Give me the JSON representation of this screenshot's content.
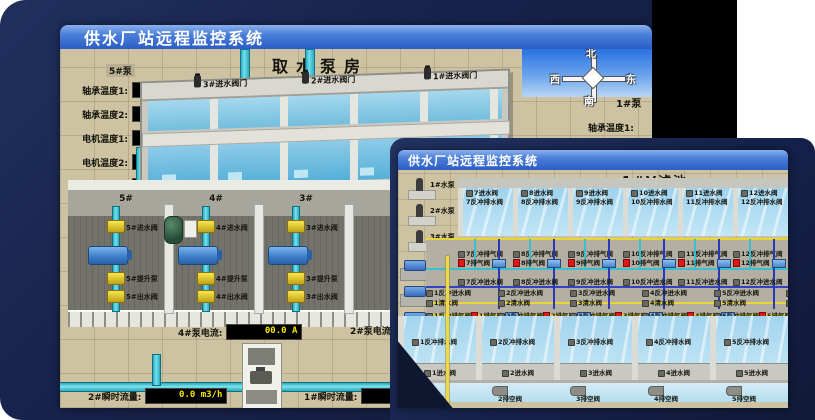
{
  "back": {
    "titlebar": "供水厂站远程监控系统",
    "scene_title": "取水泵房",
    "pump_panel": {
      "title": "5#泵",
      "rows": [
        {
          "label": "轴承温度1:",
          "value": "100.0℃"
        },
        {
          "label": "轴承温度2:",
          "value": "100.0℃"
        },
        {
          "label": "电机温度1:",
          "value": "18.1℃"
        },
        {
          "label": "电机温度2:",
          "value": "17.9℃"
        },
        {
          "label": "绕组温度1:",
          "value": "18.0℃"
        },
        {
          "label": "绕组温度2:",
          "value": "18.1℃"
        },
        {
          "label": "绕组温度3:",
          "value": "18.1℃"
        },
        {
          "label": "管道压力:",
          "value": "0.0007MPa"
        },
        {
          "label": "多功能阀:",
          "value": "0%"
        }
      ]
    },
    "intake_valves": [
      {
        "label": "3#进水阀门"
      },
      {
        "label": "2#进水阀门"
      },
      {
        "label": "1#进水阀门"
      }
    ],
    "compass": {
      "north": "北",
      "west": "西",
      "south": "南",
      "east": "东"
    },
    "right_panel": {
      "title": "1#泵",
      "labels": [
        {
          "label": "轴承温度1:"
        },
        {
          "label": "轴承温度2:"
        }
      ]
    },
    "pump_bays": [
      {
        "id": "5#",
        "inlet": "5#进水阀",
        "pump": "5#提升泵",
        "outlet": "5#出水阀"
      },
      {
        "id": "4#",
        "inlet": "4#进水阀",
        "pump": "4#提升泵",
        "outlet": "4#出水阀"
      },
      {
        "id": "3#",
        "inlet": "3#进水阀",
        "pump": "3#提升泵",
        "outlet": "3#出水阀"
      }
    ],
    "current_left": {
      "label": "4#泵电流:",
      "value": "00.0 A"
    },
    "current_right": {
      "label": "2#泵电流:"
    },
    "flow_left": {
      "label": "2#瞬时流量:",
      "value": "0.0 m3/h"
    },
    "flow_right": {
      "label": "1#瞬时流量:",
      "value": "0.0 m3/h"
    }
  },
  "front": {
    "titlebar": "供水厂站远程监控系统",
    "scene_title": "1#V滤池",
    "water_pumps": [
      {
        "label": "1#水泵"
      },
      {
        "label": "2#水泵"
      },
      {
        "label": "3#水泵"
      }
    ],
    "blowers": [
      {
        "label": "1#风机"
      },
      {
        "label": "2#风机"
      },
      {
        "label": "3#风机"
      }
    ],
    "top_cells": [
      {
        "drain": "7排空阀",
        "inlet": "7进水阀",
        "backwash_drain": "7反冲排水阀",
        "backwash_air": "7反冲排气阀",
        "air": "7排气阀",
        "backwash_inlet": "7反冲进水阀"
      },
      {
        "drain": "8排空阀",
        "inlet": "8进水阀",
        "backwash_drain": "8反冲排水阀",
        "backwash_air": "8反冲排气阀",
        "air": "8排气阀",
        "backwash_inlet": "8反冲进水阀"
      },
      {
        "drain": "9排空阀",
        "inlet": "9进水阀",
        "backwash_drain": "9反冲排水阀",
        "backwash_air": "9反冲排气阀",
        "air": "9排气阀",
        "backwash_inlet": "9反冲进水阀"
      },
      {
        "drain": "10排空阀",
        "inlet": "10进水阀",
        "backwash_drain": "10反冲排水阀",
        "backwash_air": "10反冲排气阀",
        "air": "10排气阀",
        "backwash_inlet": "10反冲进水阀"
      },
      {
        "drain": "11排空阀",
        "inlet": "11进水阀",
        "backwash_drain": "11反冲排水阀",
        "backwash_air": "11反冲排气阀",
        "air": "11排气阀",
        "backwash_inlet": "11反冲进水阀"
      },
      {
        "drain": "12排空阀",
        "inlet": "12进水阀",
        "backwash_drain": "12反冲排水阀",
        "backwash_air": "12反冲排气阀",
        "air": "12排气阀",
        "backwash_inlet": "12反冲进水阀"
      }
    ],
    "bottom_cells": [
      {
        "backwash_inlet": "1反冲进水阀",
        "clean": "1清水阀",
        "backwash_air": "1反冲排气阀",
        "air": "1排气阀",
        "backwash_drain": "1反冲排水阀",
        "inlet": "1进水阀",
        "drain": "1排空阀"
      },
      {
        "backwash_inlet": "2反冲进水阀",
        "clean": "2清水阀",
        "backwash_air": "2反冲排气阀",
        "air": "2排气阀",
        "backwash_drain": "2反冲排水阀",
        "inlet": "2进水阀",
        "drain": "2排空阀"
      },
      {
        "backwash_inlet": "3反冲进水阀",
        "clean": "3清水阀",
        "backwash_air": "3反冲排气阀",
        "air": "3排气阀",
        "backwash_drain": "3反冲排水阀",
        "inlet": "3进水阀",
        "drain": "3排空阀"
      },
      {
        "backwash_inlet": "4反冲进水阀",
        "clean": "4清水阀",
        "backwash_air": "4反冲排气阀",
        "air": "4排气阀",
        "backwash_drain": "4反冲排水阀",
        "inlet": "4进水阀",
        "drain": "4排空阀"
      },
      {
        "backwash_inlet": "5反冲进水阀",
        "clean": "5清水阀",
        "backwash_air": "5反冲排气阀",
        "air": "5排气阀",
        "backwash_drain": "5反冲排水阀",
        "inlet": "5进水阀",
        "drain": "5排空阀"
      },
      {
        "backwash_inlet": "6反冲进水阀",
        "clean": "6清水阀",
        "backwash_air": "6反冲排气阀",
        "air": "6排气阀",
        "backwash_drain": "6反冲排水阀",
        "inlet": "6进水阀",
        "drain": "6排空阀"
      }
    ]
  }
}
